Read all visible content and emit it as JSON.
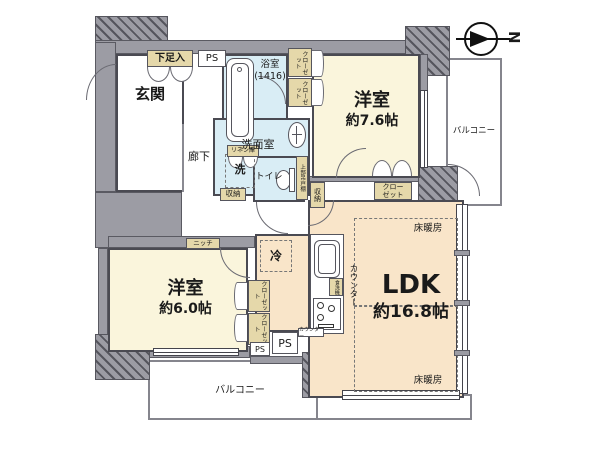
{
  "compass": {
    "label": "N"
  },
  "rooms": {
    "genkan": {
      "label": "玄関"
    },
    "rouka": {
      "label": "廊下"
    },
    "bathroom": {
      "label": "浴室",
      "size": "(1416)"
    },
    "washroom": {
      "label": "洗面室"
    },
    "washer": {
      "label": "洗"
    },
    "toilet": {
      "label": "トイレ"
    },
    "bedroom_a": {
      "label": "洋室",
      "size": "約7.6帖"
    },
    "bedroom_b": {
      "label": "洋室",
      "size": "約6.0帖"
    },
    "ldk": {
      "label": "LDK",
      "size": "約16.8帖"
    },
    "balcony_right": {
      "label": "バルコニー"
    },
    "balcony_bottom": {
      "label": "バルコニー"
    }
  },
  "storage": {
    "shoe_cabinet": "下足入",
    "linen_cabinet": "リネン庫",
    "closet_a1": "クローゼット",
    "closet_a2": "クローゼット",
    "closet_a3": "クローゼット",
    "closet_b1": "クローゼット",
    "closet_b2": "クローゼット",
    "storage_left": "収納",
    "storage_right": "収納",
    "upper_cabinet": "上部吊戸棚",
    "niche": "ニッチ"
  },
  "features": {
    "ps_top": "PS",
    "ps_small": "PS",
    "ps_large": "PS",
    "fridge": "冷",
    "counter": "カウンター",
    "counter_small": "カウンター",
    "dishwasher": "食洗機",
    "floor_heating_top": "床暖房",
    "floor_heating_bottom": "床暖房"
  },
  "colors": {
    "wall": "#9c9ca4",
    "bedroom_fill": "#faf5dc",
    "ldk_fill": "#f9e5c9",
    "wet_area_fill": "#d9edf5",
    "storage_label_fill": "#e5d8aa"
  }
}
